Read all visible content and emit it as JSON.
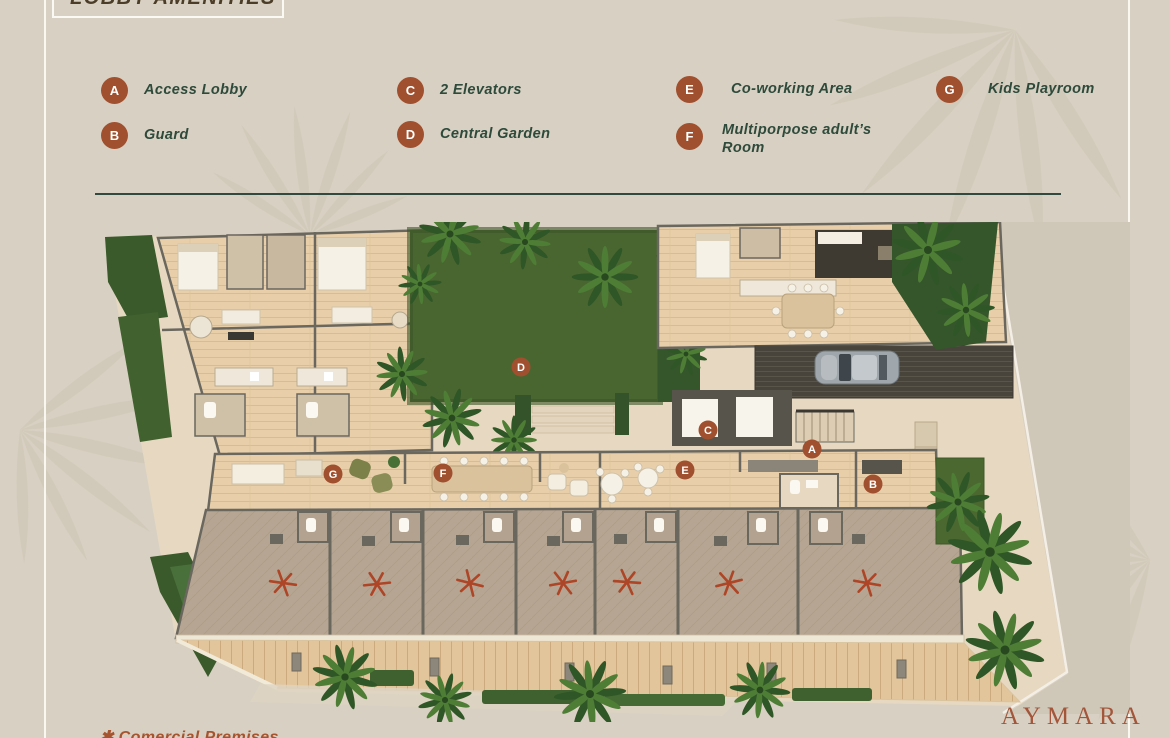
{
  "header": {
    "title": "LOBBY AMENITIES"
  },
  "legend": {
    "items": [
      {
        "letter": "A",
        "label": "Access Lobby"
      },
      {
        "letter": "B",
        "label": "Guard"
      },
      {
        "letter": "C",
        "label": "2 Elevators"
      },
      {
        "letter": "D",
        "label": "Central Garden"
      },
      {
        "letter": "E",
        "label": "Co-working Area"
      },
      {
        "letter": "F",
        "label": "Multiporpose adult’s Room"
      },
      {
        "letter": "G",
        "label": "Kids Playroom"
      }
    ]
  },
  "plan": {
    "markers": [
      {
        "letter": "A"
      },
      {
        "letter": "B"
      },
      {
        "letter": "C"
      },
      {
        "letter": "D"
      },
      {
        "letter": "E"
      },
      {
        "letter": "F"
      },
      {
        "letter": "G"
      }
    ],
    "commercial_units": 7,
    "commercial_unit_symbol": "✱"
  },
  "footer": {
    "footnote": "✱ Comercial Premises",
    "brand": "AYMARA"
  },
  "colors": {
    "background": "#d8d0c2",
    "badge": "#a0502e",
    "legend_text": "#2d4a3b",
    "title_text": "#4b3d27",
    "divider": "#31493f",
    "asterisk": "#ad4526",
    "brand": "#a3563a",
    "garden": "#4a6630",
    "wood": "#e8cfa9",
    "walls": "#6a675f"
  }
}
